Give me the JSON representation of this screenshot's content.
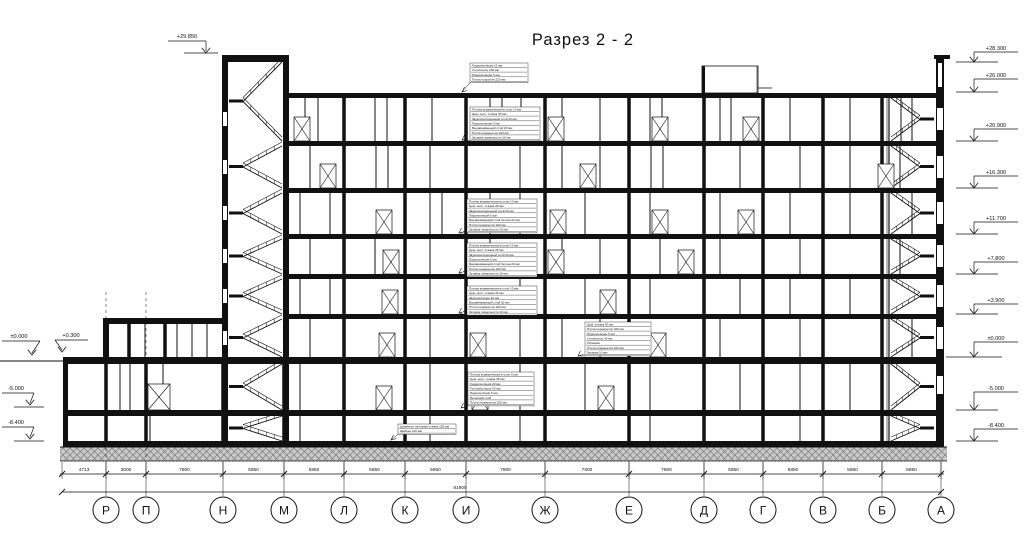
{
  "title": "Разрез 2 - 2",
  "drawing_type": "building cross-section",
  "elevations": {
    "left": [
      "+29.850",
      "±0.000",
      "+0.300",
      "-5.000",
      "-8.400"
    ],
    "right": [
      "+28.300",
      "+26.000",
      "+20.900",
      "+16.300",
      "+11.700",
      "+7.800",
      "+3.900",
      "±0.000",
      "-5.000",
      "-8.400"
    ]
  },
  "axes": [
    "Р",
    "П",
    "Н",
    "М",
    "Л",
    "К",
    "И",
    "Ж",
    "Е",
    "Д",
    "Г",
    "В",
    "Б",
    "А"
  ],
  "dimensions": {
    "segments": [
      "4713",
      "3000",
      "7800",
      "5850",
      "5850",
      "5850",
      "5850",
      "7800",
      "7600",
      "7800",
      "5850",
      "5850",
      "5850",
      "5850"
    ],
    "total": "81900"
  },
  "callouts": [
    {
      "name": "roof-composition",
      "lines": [
        "Гидроизоляция 12 мм",
        "Утеплитель 150 мм",
        "Пароизоляция 5 мм",
        "Плита покрытия 220 мм"
      ]
    },
    {
      "name": "floor-composition-6",
      "lines": [
        "Плитка керамическая в слое 10 мм",
        "Цем.-песч. стяжка 35 мм",
        "Звукоизоляционный слой 20 мм",
        "Пароизоляция 5 мм",
        "Выравнивающий слой 20 мм",
        "Плита перекрытия 220 мм",
        "Затирка поверхности 10 мм"
      ]
    },
    {
      "name": "floor-composition-5",
      "lines": [
        "Плитка керамическая в слое 10 мм",
        "Цем.-песч. стяжка 35 мм",
        "Звукоизоляционный слой 20 мм",
        "Пароизоляция 5 мм",
        "Выравнивающий слой бетона 20 мм",
        "Плита перекрытия 220 мм",
        "Затирка поверхности 10 мм"
      ]
    },
    {
      "name": "floor-composition-4",
      "lines": [
        "Плитка керамическая в слое 10 мм",
        "Цем.-песч. стяжка 35 мм",
        "Звукоизоляционный слой 20 мм",
        "Пароизоляция 5 мм",
        "Выравнивающий слой бетона 20 мм",
        "Плита перекрытия 220 мм",
        "Затирка поверхности 10 мм"
      ]
    },
    {
      "name": "floor-composition-3",
      "lines": [
        "Плитка керамическая в слое 10 мм",
        "Цем.-песч. стяжка 35 мм",
        "Звукоизоляция 20 мм",
        "Выравнивающий слой 20 мм",
        "Плита перекрытия 220 мм",
        "Затирка поверхности 10 мм"
      ]
    },
    {
      "name": "floor-composition-2",
      "lines": [
        "Цем. стяжка 50 мм",
        "Плита перекрытия 220 мм",
        "Пароизоляция 5 мм",
        "Утеплитель 40 мм",
        "Обшивка",
        "Плита перекрытия 220 мм",
        "Затирка 10 мм"
      ]
    },
    {
      "name": "floor-composition-1",
      "lines": [
        "Плитка керамическая в слое 5 мм",
        "Цем.-песч. стяжка 35 мм",
        "Гидроизоляция 20 мм",
        "Теплоизоляция 20 мм",
        "Пароизоляция 5 мм",
        "Бетонный слой",
        "Плита перекрытия 220 мм"
      ]
    },
    {
      "name": "basement-floor",
      "lines": [
        "Цементно-песчаная стяжка 100 мм",
        "Щебень 120 мм"
      ]
    }
  ]
}
